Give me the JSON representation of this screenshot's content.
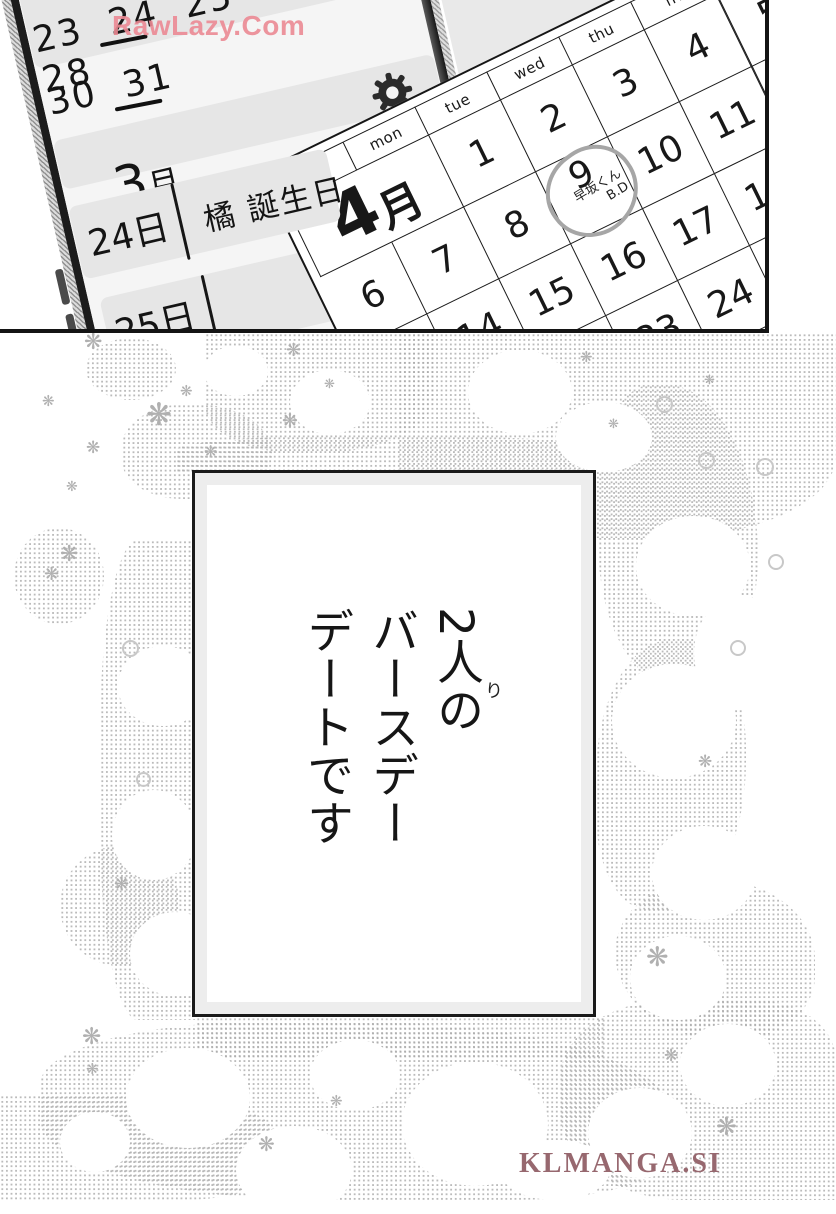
{
  "watermarks": {
    "top": "RawLazy.Com",
    "bottom": "KLMANGA.SI"
  },
  "colors": {
    "watermark_top": "#ec8a94",
    "watermark_bottom": "#97686f",
    "panel_line": "#1a1a1a",
    "tone_dot": "#ababab",
    "handwritten_circle": "#a6a6a6",
    "wall_shade": "#e9e9e9"
  },
  "icons": {
    "sparkle": "❋"
  },
  "phone_calendar": {
    "week_row_1": "23 24 25 26 27 28",
    "week_row_2": "30 31",
    "underlined_dates": [
      "24",
      "31"
    ],
    "month_number": "3",
    "month_suffix": "月",
    "event_row": {
      "day": "24日",
      "title": "橘 誕生日"
    },
    "next_row": {
      "day": "25日"
    }
  },
  "wall_calendar": {
    "month_number": "4",
    "month_suffix": "月",
    "day_headers": [
      "sun",
      "mon",
      "tue",
      "wed",
      "thu",
      "fri",
      "sat"
    ],
    "weeks": [
      [
        "",
        "",
        "1",
        "2",
        "3",
        "4",
        "5"
      ],
      [
        "6",
        "7",
        "8",
        "9",
        "10",
        "11",
        "12"
      ],
      [
        "13",
        "14",
        "15",
        "16",
        "17",
        "18",
        "19"
      ],
      [
        "20",
        "21",
        "22",
        "23",
        "24",
        "25",
        "26"
      ]
    ],
    "circled_date": "9",
    "handwritten_note": "早坂くん\nB.D"
  },
  "caption_panel": {
    "text": "2人の\nバースデー\nデートです",
    "furigana": "り"
  }
}
